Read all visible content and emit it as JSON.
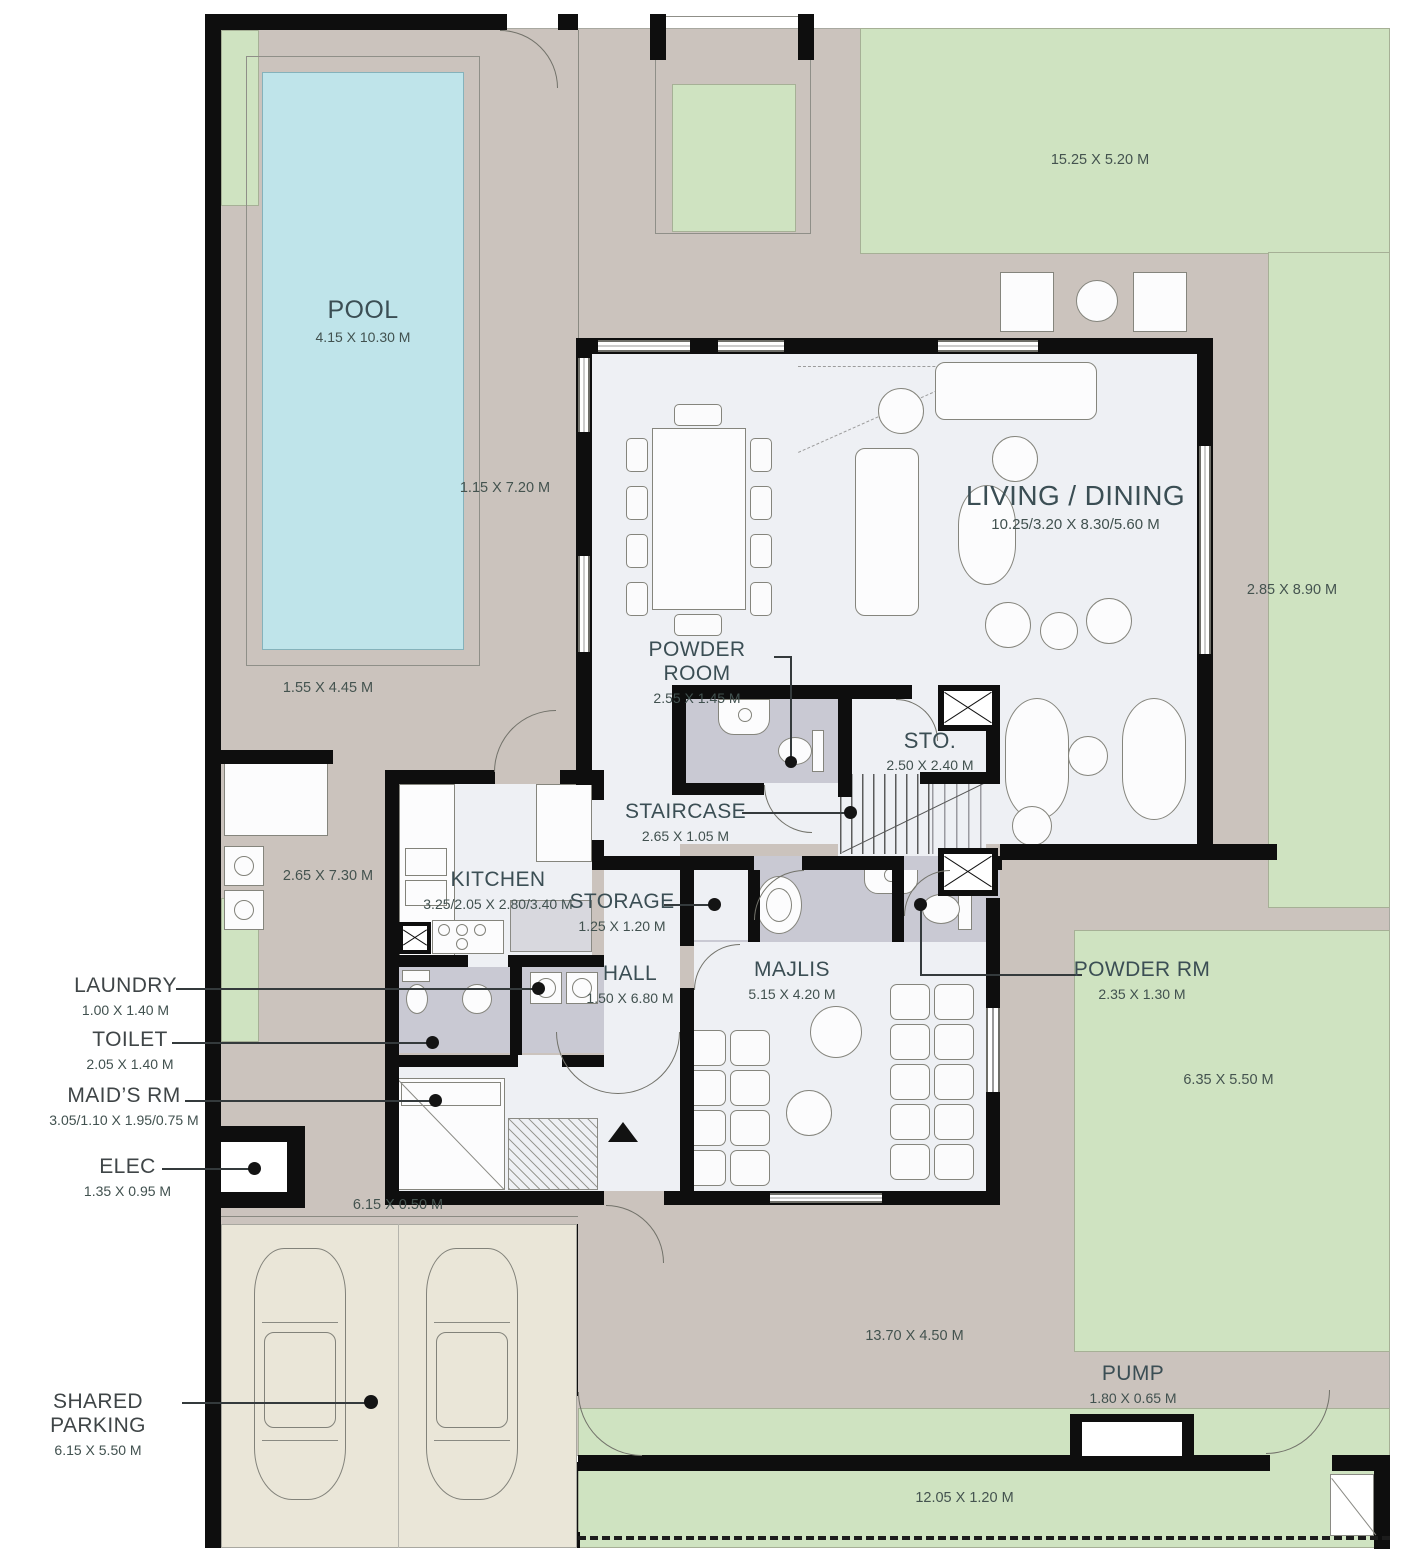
{
  "rooms": {
    "pool": {
      "label": "POOL",
      "dims": "4.15 X 10.30 M"
    },
    "living_dining": {
      "label": "LIVING / DINING",
      "dims": "10.25/3.20 X 8.30/5.60 M"
    },
    "powder_room": {
      "label": "POWDER ROOM",
      "dims": "2.55 X 1.45 M"
    },
    "sto": {
      "label": "STO.",
      "dims": "2.50 X 2.40 M"
    },
    "staircase": {
      "label": "STAIRCASE",
      "dims": "2.65 X 1.05 M"
    },
    "kitchen": {
      "label": "KITCHEN",
      "dims": "3.25/2.05 X 2.80/3.40 M"
    },
    "storage": {
      "label": "STORAGE",
      "dims": "1.25 X 1.20 M"
    },
    "hall": {
      "label": "HALL",
      "dims": "1.50 X 6.80 M"
    },
    "majlis": {
      "label": "MAJLIS",
      "dims": "5.15 X 4.20 M"
    },
    "powder_rm": {
      "label": "POWDER RM",
      "dims": "2.35 X 1.30 M"
    },
    "laundry": {
      "label": "LAUNDRY",
      "dims": "1.00 X 1.40 M"
    },
    "toilet": {
      "label": "TOILET",
      "dims": "2.05 X 1.40 M"
    },
    "maids_rm": {
      "label": "MAID’S RM",
      "dims": "3.05/1.10 X 1.95/0.75 M"
    },
    "elec": {
      "label": "ELEC",
      "dims": "1.35 X 0.95 M"
    },
    "shared_parking": {
      "label": "SHARED PARKING",
      "dims": "6.15 X 5.50 M"
    },
    "pump": {
      "label": "PUMP",
      "dims": "1.80 X 0.65 M"
    }
  },
  "site": {
    "garden_top": "15.25 X 5.20 M",
    "pool_side": "1.15 X 7.20 M",
    "garden_right": "2.85 X 8.90 M",
    "pool_bottom": "1.55 X 4.45 M",
    "terrace_left": "2.65 X 7.30 M",
    "walkway": "6.15 X 0.50 M",
    "garden_right_lower": "6.35 X 5.50 M",
    "yard_bottom": "13.70 X 4.50 M",
    "garden_bottom": "12.05 X 1.20 M"
  },
  "colors": {
    "wall": "#0e0e0e",
    "terrace": "#cbc3bd",
    "garden": "#cfe3c1",
    "pool": "#bfe4ea",
    "interior": "#eef0f4",
    "wetroom": "#c9c9d3",
    "parking": "#eae6d8",
    "label": "#3b4e54"
  }
}
